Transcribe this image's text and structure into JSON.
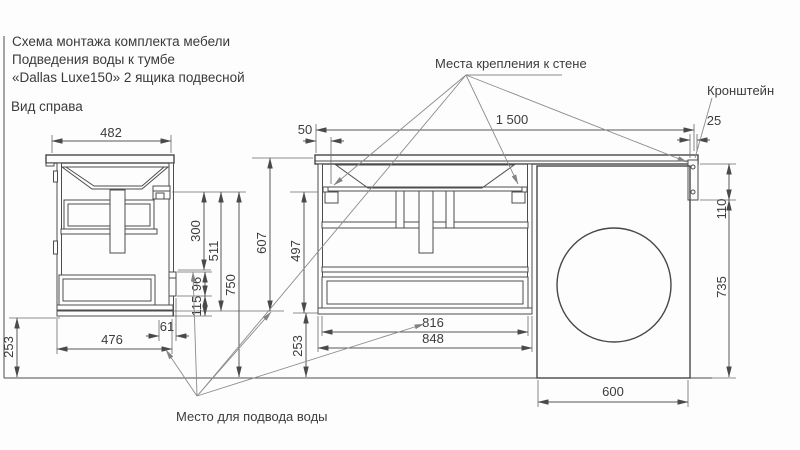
{
  "title": {
    "line1": "Схема монтажа комплекта мебели",
    "line2": "Подведения воды к тумбе",
    "line3": "«Dallas Luxe150» 2 ящика подвесной"
  },
  "view_label": "Вид справа",
  "labels": {
    "wall_mounts": "Места крепления к стене",
    "bracket": "Кронштейн",
    "water_supply": "Место для подвода воды"
  },
  "dimensions": {
    "d482": "482",
    "d476": "476",
    "d61": "61",
    "d253_side": "253",
    "d300": "300",
    "d511": "511",
    "d750": "750",
    "d96": "96",
    "d115": "115",
    "d607": "607",
    "d497": "497",
    "d253_front": "253",
    "d50": "50",
    "d1500": "1 500",
    "d25": "25",
    "d816": "816",
    "d848": "848",
    "d110": "110",
    "d735": "735",
    "d600": "600"
  },
  "colors": {
    "line": "#474747",
    "dimension": "#565656",
    "leader": "#8b8b8b",
    "text": "#3c3c3c",
    "background": "#fdfdfd"
  }
}
